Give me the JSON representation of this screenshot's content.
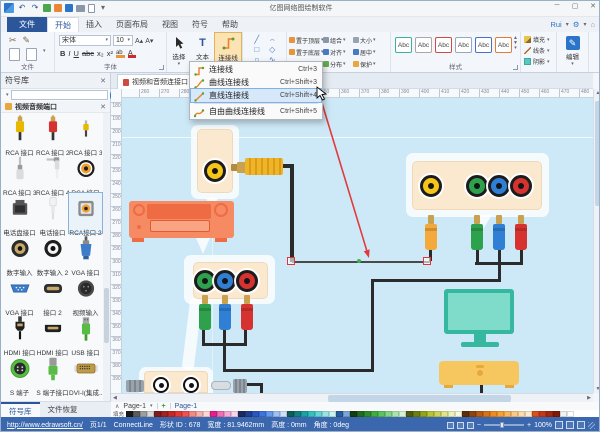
{
  "window": {
    "title": "亿图网络图绘制软件"
  },
  "icon_glyphs": {
    "dropdown": "▾",
    "close": "✕",
    "undo": "↶",
    "redo": "↷",
    "scissors": "✂",
    "brush": "✎",
    "minimize": "─",
    "maximize": "▢",
    "collapse": "∧",
    "left_arrow": "◀",
    "right_arrow": "▶",
    "up_arrow": "▲",
    "down_arrow": "▼",
    "gear": "⚙",
    "pin": "⌂",
    "font_grow": "A▴",
    "font_shrink": "A▾",
    "line_spacing": "≡",
    "list": "☰",
    "text_tool": "T",
    "edit_pencil": "✎"
  },
  "tab_row": {
    "file_tab": "文件",
    "tabs": [
      "开始",
      "插入",
      "页面布局",
      "视图",
      "符号",
      "帮助"
    ],
    "active_tab": "开始",
    "account": {
      "user": "Rui"
    }
  },
  "ribbon": {
    "clipboard_group_label": "文件",
    "font_group_label": "字体",
    "style_group_label": "样式",
    "font_name": "宋体",
    "font_size": "10",
    "format_buttons": [
      "B",
      "I",
      "U",
      "abc",
      "x₂",
      "x²"
    ],
    "shape_tools": [
      "╱",
      "⌢",
      "□",
      "◇",
      "○",
      "∿"
    ],
    "tool_buttons": {
      "select": "选择",
      "text": "文本",
      "connector": "连接线"
    },
    "arrange_buttons": [
      "置于顶层",
      "置于底层",
      "旋转和翻转",
      "组合",
      "对齐",
      "分布",
      "大小",
      "居中",
      "保护"
    ],
    "style_swatches": [
      {
        "label": "Abc",
        "color": "#3fae9e"
      },
      {
        "label": "Abc",
        "color": "#a8a8a8"
      },
      {
        "label": "Abc",
        "color": "#cf4a3f"
      },
      {
        "label": "Abc",
        "color": "#98a6b8"
      },
      {
        "label": "Abc",
        "color": "#4472c4"
      },
      {
        "label": "Abc",
        "color": "#e07b39"
      }
    ],
    "style_buttons": {
      "fill": "填充",
      "line": "线条",
      "shadow": "阴影"
    },
    "edit_button": "编辑"
  },
  "connector_menu": {
    "items": [
      {
        "label": "连接线",
        "shortcut": "Ctrl+3",
        "icon": "connector",
        "highlighted": false
      },
      {
        "label": "曲线连接线",
        "shortcut": "Ctrl+Shift+3",
        "icon": "curve",
        "highlighted": false
      },
      {
        "label": "直线连接线",
        "shortcut": "Ctrl+Shift+4",
        "icon": "straight",
        "highlighted": true
      },
      {
        "label": "自由曲线连接线",
        "shortcut": "Ctrl+Shift+5",
        "icon": "freecurve",
        "highlighted": false,
        "separator_before": true
      }
    ]
  },
  "sidebar": {
    "title": "符号库",
    "section": "视频音频端口",
    "bottom_tabs": [
      "符号库",
      "文件恢复"
    ],
    "symbols": [
      {
        "label": "RCA 接口",
        "icon": "rca-yellow"
      },
      {
        "label": "RCA 接口 2",
        "icon": "rca-red"
      },
      {
        "label": "RCA 接口 3",
        "icon": "plug-mini"
      },
      {
        "label": "RCA 接口 3",
        "icon": "jack"
      },
      {
        "label": "RCA 接口 4",
        "icon": "jack-angled"
      },
      {
        "label": "RCA 接口",
        "icon": "port-orange"
      },
      {
        "label": "电话盘接口",
        "icon": "phone-jack"
      },
      {
        "label": "电话接口",
        "icon": "phone-plug"
      },
      {
        "label": "RCA接口 2",
        "icon": "port-square",
        "selected": true
      },
      {
        "label": "数字输入",
        "icon": "port-black"
      },
      {
        "label": "数字输入 2",
        "icon": "port-black2"
      },
      {
        "label": "VGA 接口",
        "icon": "vga-cable"
      },
      {
        "label": "VGA 接口",
        "icon": "vga-port"
      },
      {
        "label": "接口 2",
        "icon": "port-wide"
      },
      {
        "label": "视频输入",
        "icon": "video-in"
      },
      {
        "label": "HDMI 接口",
        "icon": "hdmi-cable"
      },
      {
        "label": "HDMI 接口",
        "icon": "hdmi-port"
      },
      {
        "label": "USB 接口",
        "icon": "usb"
      },
      {
        "label": "S 端子",
        "icon": "svideo-round"
      },
      {
        "label": "S 端子接口",
        "icon": "svideo-plug"
      },
      {
        "label": "DVI-I(集成...",
        "icon": "dvi"
      },
      {
        "label": "",
        "icon": "dvi"
      },
      {
        "label": "",
        "icon": "dvi"
      },
      {
        "label": "",
        "icon": "dvi"
      }
    ]
  },
  "document": {
    "tab_title": "视频和音频连接口"
  },
  "rulers": {
    "horizontal": {
      "start": 260,
      "step": 10,
      "count": 23,
      "px": 20,
      "offset": 17
    },
    "vertical": {
      "start": 180,
      "step": 10,
      "count": 22,
      "px": 13,
      "offset": 13
    }
  },
  "canvas_content": {
    "devices": [
      "speaker-panel-yellow-port",
      "av-receiver",
      "component-panel-3-ports",
      "rca-output-panel-4-ports",
      "tv",
      "soundbar",
      "speaker-box-2-ports",
      "gray-connectors"
    ],
    "port_colors": [
      "#f5c518",
      "#2ea14d",
      "#2f7fd4",
      "#d63330"
    ],
    "cable_color": "#2b2b2b",
    "selected_connector": {
      "type": "straight-line",
      "color": "#4a4a4a",
      "handle_color": "#e03636",
      "midpoint_color": "#3bb54a"
    },
    "annotation_arrow_color": "#e23a3a"
  },
  "page_bar": {
    "page_selector": "Page-1",
    "add": "+",
    "active_page_tab": "Page-1"
  },
  "palette_label": "填充",
  "palette": [
    "#1a1a1a",
    "#5c5c5c",
    "#9e9e9e",
    "#d9d9d9",
    "#7f1d1d",
    "#a32222",
    "#c62828",
    "#e53935",
    "#ef5350",
    "#f28b82",
    "#f6b1ac",
    "#fbd8d5",
    "#e91e8c",
    "#f06eb5",
    "#f8a8d4",
    "#fcd4ea",
    "#1a2b5c",
    "#1f3f8f",
    "#2857c2",
    "#3b74e0",
    "#6698ec",
    "#9ec0f4",
    "#cfe0fa",
    "#0f5c5c",
    "#148080",
    "#1aa3a3",
    "#33c2c2",
    "#66d4d4",
    "#99e3e3",
    "#ccf1f1",
    "#265c9e",
    "#7aa6d8",
    "#143d14",
    "#1f6b1f",
    "#2e8b2e",
    "#3fae3f",
    "#5cc45c",
    "#84d584",
    "#ace5ac",
    "#d5f2d5",
    "#4d5c0f",
    "#6e8014",
    "#93a31a",
    "#b8c433",
    "#cdd45c",
    "#dfe38a",
    "#eef1b8",
    "#f8f9dd",
    "#5c2e0a",
    "#8a4510",
    "#b85c14",
    "#d9731a",
    "#ef8c1f",
    "#f7a133",
    "#fab65c",
    "#fcca84",
    "#fddcac",
    "#fee9cc",
    "#d94f1e",
    "#c23a14",
    "#a3280f",
    "#7f1a0a",
    "#f2f2f2",
    "#ffffff"
  ],
  "status_bar": {
    "link": "http://www.edrawsoft.cn/",
    "page_indicator": "页1/1",
    "tool_name": "ConnectLine",
    "shape_id": "形状 ID : 678",
    "shape_width": "宽度 : 81.9462mm",
    "shape_height": "高度 : 0mm",
    "shape_angle": "角度 : 0deg",
    "zoom_minus": "−",
    "zoom_plus": "+",
    "zoom_level": "100%"
  }
}
